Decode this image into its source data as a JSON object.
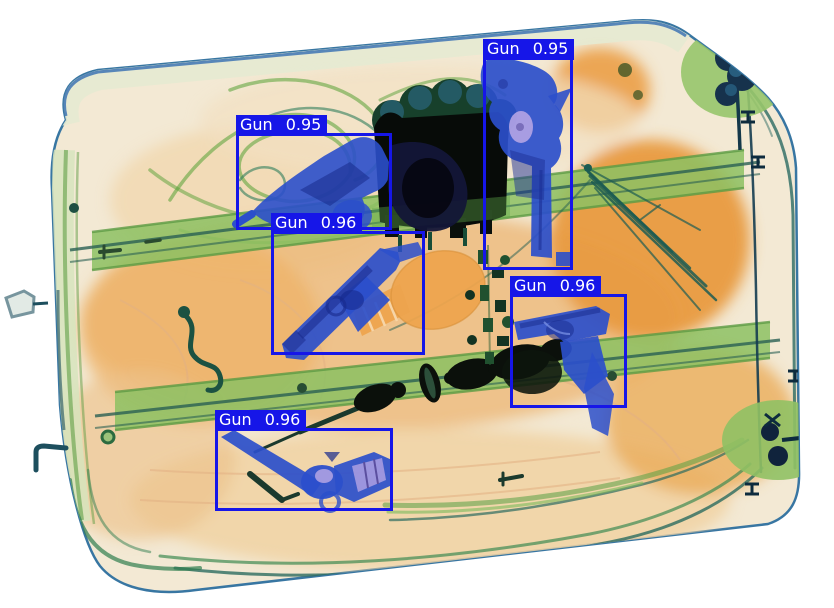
{
  "scan": {
    "kind": "xray-baggage-scan",
    "colors": {
      "detection_box": "#1616e8",
      "label_text": "#ffffff",
      "background": "#ffffff",
      "case_fabric_orange": "#eca54f",
      "strap_green": "#8cc163",
      "dense_metal_dark": "#0b100b",
      "gun_blue": "#2b4fcb",
      "grip_lavender": "#b4a4e4",
      "wire_teal": "#1d5c52"
    }
  },
  "detections": [
    {
      "object": "Gun",
      "score": "0.95",
      "x": 483,
      "y": 57,
      "w": 90,
      "h": 213
    },
    {
      "object": "Gun",
      "score": "0.95",
      "x": 236,
      "y": 133,
      "w": 156,
      "h": 97
    },
    {
      "object": "Gun",
      "score": "0.96",
      "x": 271,
      "y": 231,
      "w": 154,
      "h": 124
    },
    {
      "object": "Gun",
      "score": "0.96",
      "x": 510,
      "y": 294,
      "w": 117,
      "h": 114
    },
    {
      "object": "Gun",
      "score": "0.96",
      "x": 215,
      "y": 428,
      "w": 178,
      "h": 83
    }
  ]
}
